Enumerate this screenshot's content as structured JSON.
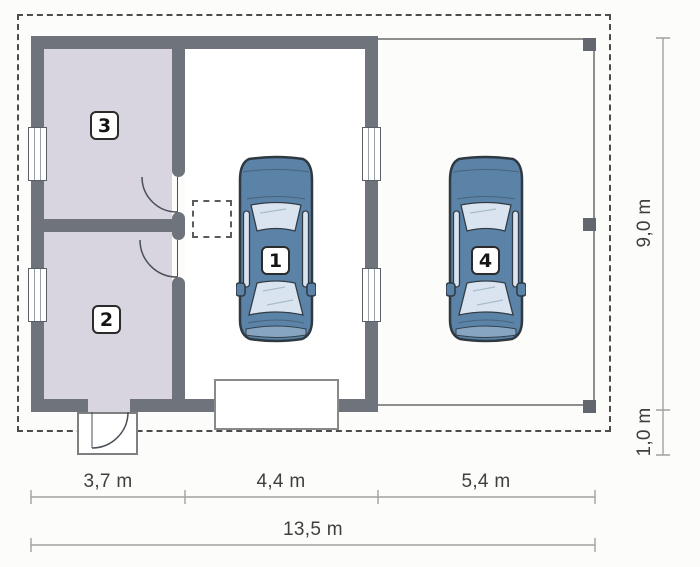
{
  "plan": {
    "type": "garage-floor-plan",
    "labels": {
      "garage_car": "1",
      "room2": "2",
      "room3": "3",
      "carport_car": "4"
    },
    "dimensions": {
      "seg1": "3,7 m",
      "seg2": "4,4 m",
      "seg3": "5,4 m",
      "total": "13,5 m",
      "depth": "9,0 m",
      "offset": "1,0 m"
    }
  },
  "colors": {
    "wall": "#6e737c",
    "pillar": "#62666e",
    "room_floor": "#d8d4e0",
    "boundary": "#4c4c4c",
    "thin_line": "#8f8f8f",
    "line": "#a0a0a0",
    "text": "#3f3f3f",
    "car_body": "#5b83a7",
    "car_glass": "#dae4f0"
  }
}
